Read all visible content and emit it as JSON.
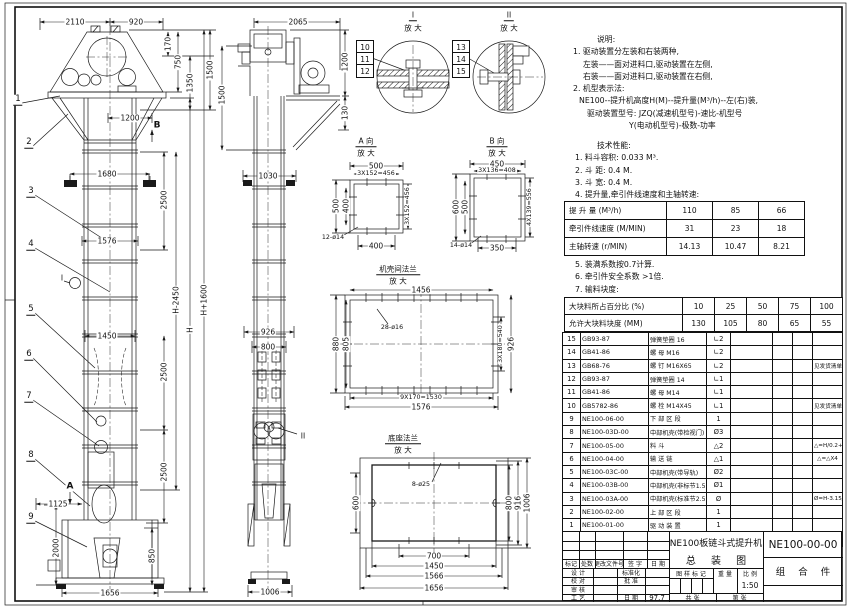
{
  "front": {
    "t2110": "2110",
    "t920": "920",
    "v170": "170",
    "v750": "750",
    "v1350": "1350",
    "v1500": "1500",
    "h1200": "1200",
    "h1680": "1680",
    "v2500a": "2500",
    "h1576": "1576",
    "vh1600": "H+1600",
    "vh": "H",
    "vh2450": "H-2450",
    "h1450": "1450",
    "v2500b": "2500",
    "v2500c": "2500",
    "h1125": "1125",
    "v2000": "2000",
    "v850": "850",
    "h1656": "1656",
    "balloons": [
      "1",
      "2",
      "3",
      "4",
      "5",
      "6",
      "7",
      "8",
      "9"
    ],
    "marker_a": "A",
    "marker_b": "B",
    "marker_i": "I"
  },
  "side": {
    "t2065": "2065",
    "v1500": "1500",
    "v1200": "1200",
    "v130": "130",
    "h1030": "1030",
    "h926": "926",
    "h800": "800",
    "h1006": "1006",
    "marker_ii": "II"
  },
  "detail_i": {
    "title": "I",
    "subtitle": "放 大",
    "balloons": [
      "10",
      "11",
      "12"
    ]
  },
  "detail_ii": {
    "title": "II",
    "subtitle": "放 大",
    "balloons": [
      "13",
      "14",
      "15"
    ]
  },
  "view_a": {
    "title": "A 向",
    "subtitle": "放 大",
    "top": "500",
    "top2": "3X152=456",
    "left": "500",
    "left2": "400",
    "right": "3X152=456",
    "bottom": "400",
    "holes": "12-ø14"
  },
  "view_b": {
    "title": "B 向",
    "subtitle": "放 大",
    "top": "450",
    "top2": "3X136=408",
    "left": "600",
    "left2": "500",
    "right": "4X139=556",
    "bottom": "350",
    "holes": "14-ø14"
  },
  "flange": {
    "title": "机壳间法兰",
    "subtitle": "放 大",
    "top": "1456",
    "holes": "28-ø16",
    "l1": "880",
    "l2": "805",
    "r1": "3X180=540",
    "r2": "926",
    "b1": "9X170=1530",
    "b2": "1576"
  },
  "base": {
    "title": "底座法兰",
    "subtitle": "放 大",
    "holes": "8-ø25",
    "left": "600",
    "r1": "800",
    "r2": "916",
    "r3": "1006",
    "b1": "700",
    "b2": "1450",
    "b3": "1566",
    "b4": "1656"
  },
  "notes": {
    "heading": "说明:",
    "l1": "1. 驱动装置分左装和右装两种,",
    "l2": "左装——面对进料口,驱动装置在左侧,",
    "l3": "右装——面对进料口,驱动装置在右侧,",
    "l4": "2. 机型表示法:",
    "l5": "NE100--提升机高度H(M)--提升量(M³/h)--左(右)装,",
    "l6": "驱动装置型号: JZQ(减速机型号)-速比-机型号",
    "l7": "Y(电动机型号)-极数-功率"
  },
  "tech": {
    "heading": "技术性能:",
    "b1": "1. 料斗容积: 0.033 M³.",
    "b2": "2. 斗  距: 0.4 M.",
    "b3": "3. 斗  宽: 0.4 M.",
    "b4": "4. 提升量,牵引件线速度和主轴转速:",
    "a1": "5. 装满系数按0.7计算.",
    "a2": "6. 牵引件安全系数 >1倍.",
    "a3": "7. 输料块度:"
  },
  "perf_table": {
    "rows": [
      {
        "label": "提 升 量  (M³/h)",
        "v1": "110",
        "v2": "85",
        "v3": "66"
      },
      {
        "label": "牵引件线速度 (M/MIN)",
        "v1": "31",
        "v2": "23",
        "v3": "18"
      },
      {
        "label": "主轴转速 (r/MIN)",
        "v1": "14.13",
        "v2": "10.47",
        "v3": "8.21"
      }
    ]
  },
  "lump_table": {
    "rows": [
      {
        "label": "大块料所占百分比 (%)",
        "v1": "10",
        "v2": "25",
        "v3": "50",
        "v4": "75",
        "v5": "100"
      },
      {
        "label": "允许大块料块度 (MM)",
        "v1": "130",
        "v2": "105",
        "v3": "80",
        "v4": "65",
        "v5": "55"
      }
    ]
  },
  "parts": {
    "headers": [
      "序号",
      "代  号",
      "名    称",
      "数 量",
      "材  料",
      "单重",
      "总重",
      "备  注"
    ],
    "rows": [
      [
        "15",
        "GB93-87",
        "弹簧垫圈  16",
        "∟2",
        "",
        "",
        "",
        ""
      ],
      [
        "14",
        "GB41-86",
        "螺  母  M16",
        "∟2",
        "",
        "",
        "",
        ""
      ],
      [
        "13",
        "GB68-76",
        "螺  钉  M16X65",
        "∟2",
        "",
        "",
        "",
        "见发货清单"
      ],
      [
        "12",
        "GB93-87",
        "弹簧垫圈  14",
        "∟1",
        "",
        "",
        "",
        ""
      ],
      [
        "11",
        "GB41-86",
        "螺  母  M14",
        "∟1",
        "",
        "",
        "",
        ""
      ],
      [
        "10",
        "GB5782-86",
        "螺  栓  M14X45",
        "∟1",
        "",
        "",
        "",
        "见发货清单"
      ],
      [
        "9",
        "NE100-06-00",
        "下 部 区 段",
        "1",
        "",
        "",
        "",
        ""
      ],
      [
        "8",
        "NE100-03D-00",
        "中部机壳(带检视门)",
        "Ø3",
        "",
        "",
        "",
        ""
      ],
      [
        "7",
        "NE100-05-00",
        "料  斗",
        "△2",
        "",
        "",
        "",
        "△=H/0.2+5.75"
      ],
      [
        "6",
        "NE100-04-00",
        "输 送 链",
        "△1",
        "",
        "",
        "",
        "△=△X4"
      ],
      [
        "5",
        "NE100-03C-00",
        "中部机壳(带导轨)",
        "Ø2",
        "",
        "",
        "",
        ""
      ],
      [
        "4",
        "NE100-03B-00",
        "中部机壳(非标节1.5M,1M)",
        "Ø1",
        "",
        "",
        "",
        ""
      ],
      [
        "3",
        "NE100-03A-00",
        "中部机壳(标准节2.5M)",
        "Ø",
        "",
        "",
        "",
        "Ø=H-3.15/2.5"
      ],
      [
        "2",
        "NE100-02-00",
        "上 部 区 段",
        "1",
        "",
        "",
        "",
        ""
      ],
      [
        "1",
        "NE100-01-00",
        "驱 动 装 置",
        "1",
        "",
        "",
        "",
        ""
      ]
    ]
  },
  "title_block": {
    "title_line1": "NE100板链斗式提升机",
    "title_line2": "总  装  图",
    "drawing_no": "NE100-00-00",
    "type_label": "组 合 件",
    "rev_headers": [
      "标记",
      "处数",
      "更改文件号",
      "签 字",
      "日 期"
    ],
    "roles_col1": [
      "设 计",
      "校 对",
      "审 核",
      "工 艺"
    ],
    "roles_col3": [
      "标准化",
      "批 准",
      "",
      "日 期"
    ],
    "roles_col4": [
      "",
      "",
      "",
      "97.7"
    ],
    "mark_label": "图 样 标 记",
    "weight_label": "重 量",
    "scale_label": "比 例",
    "scale": "1:50",
    "sheet_label_1": "共  张",
    "sheet_label_2": "第  张"
  }
}
